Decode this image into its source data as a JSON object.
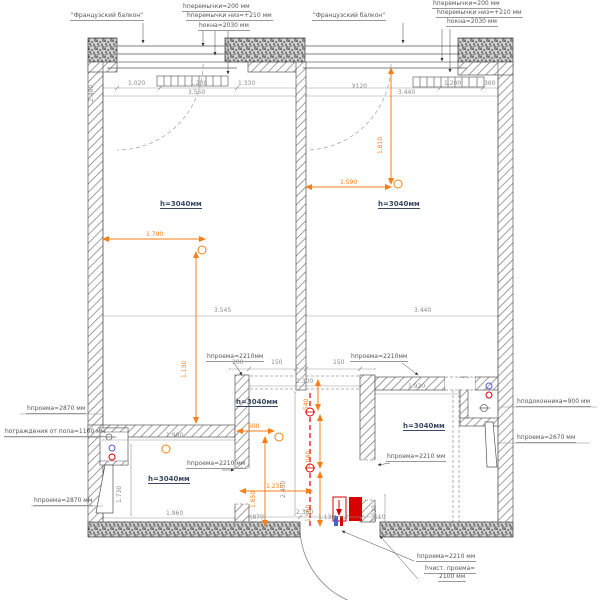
{
  "title": "Обмерный план квартиры (floor plan with heights of openings)",
  "colors": {
    "dim_orange": "#f87f17",
    "accent_red": "#d60000",
    "accent_blue": "#4a5fd0",
    "line_grey": "#8a8a8a",
    "wall_dark": "#444444",
    "room_label": "#3b4a63"
  },
  "rooms": {
    "top_left": {
      "label": "h=3040мм"
    },
    "top_right": {
      "label": "h=3040мм"
    },
    "middle": {
      "label": "h=3040мм"
    },
    "bottom_left": {
      "label": "h=3040мм"
    },
    "bottom_right": {
      "label": "h=3040мм"
    }
  },
  "callouts": [
    {
      "n": "balcony-left-label",
      "t": "\"Французский балкон\"",
      "x": 70,
      "y": 13
    },
    {
      "n": "balcony-right-label",
      "t": "\"Французский балкон\"",
      "x": 312,
      "y": 13
    },
    {
      "n": "lintel-left-label",
      "t": "hперемычки=200 мм",
      "x": 182,
      "y": 4
    },
    {
      "n": "lintel-low-left-label",
      "t": "hперемычки низ=+210 мм",
      "x": 186,
      "y": 13
    },
    {
      "n": "window-left-label",
      "t": "hокна=2030 мм",
      "x": 198,
      "y": 23
    },
    {
      "n": "lintel-right-label",
      "t": "hперемычки=200 мм",
      "x": 432,
      "y": 1
    },
    {
      "n": "lintel-low-right-label",
      "t": "hперемычки низ=+210 мм",
      "x": 436,
      "y": 10
    },
    {
      "n": "window-right-label",
      "t": "hокна=2030 мм",
      "x": 446,
      "y": 19
    },
    {
      "n": "left-opening-label-1",
      "t": "hпроема=2870 мм",
      "x": 26,
      "y": 406
    },
    {
      "n": "left-railing-label",
      "t": "hограждения от пола=1100 мм",
      "x": 4,
      "y": 429
    },
    {
      "n": "left-opening-label-2",
      "t": "hпроема=2870 мм",
      "x": 33,
      "y": 498
    },
    {
      "n": "right-sill-label",
      "t": "hподоконника=900 мм",
      "x": 516,
      "y": 399
    },
    {
      "n": "right-opening-label",
      "t": "hпроема=2670 мм",
      "x": 516,
      "y": 435
    },
    {
      "n": "door-opening-label",
      "t": "hпроема=2210 мм",
      "x": 416,
      "y": 554
    },
    {
      "n": "door-clear-label-1",
      "t": "hчист. проема=",
      "x": 424,
      "y": 566
    },
    {
      "n": "door-clear-label-2",
      "t": "2100 мм",
      "x": 438,
      "y": 574
    },
    {
      "n": "opening-label-bath-left",
      "t": "hпроема=2210мм",
      "x": 206,
      "y": 354
    },
    {
      "n": "opening-label-bath-right",
      "t": "hпроема=2210мм",
      "x": 350,
      "y": 354
    },
    {
      "n": "opening-label-room-left",
      "t": "hпроема=2210 мм",
      "x": 186,
      "y": 461
    },
    {
      "n": "opening-label-room-right",
      "t": "hпроема=2210 мм",
      "x": 386,
      "y": 454
    }
  ],
  "grey_dims": [
    {
      "t": "1.020",
      "x": 128,
      "y": 81
    },
    {
      "t": "1.200",
      "x": 190,
      "y": 81
    },
    {
      "t": "1.330",
      "x": 238,
      "y": 81
    },
    {
      "t": "3.550",
      "x": 188,
      "y": 90
    },
    {
      "t": "У120",
      "x": 352,
      "y": 84
    },
    {
      "t": "3.440",
      "x": 398,
      "y": 90
    },
    {
      "t": "1.200",
      "x": 444,
      "y": 81
    },
    {
      "t": "360",
      "x": 484,
      "y": 81
    },
    {
      "t": "2.480",
      "x": 95,
      "y": 96,
      "v": 1
    },
    {
      "t": "3.545",
      "x": 214,
      "y": 308
    },
    {
      "t": "3.440",
      "x": 414,
      "y": 308
    },
    {
      "t": "200",
      "x": 232,
      "y": 360
    },
    {
      "t": "150",
      "x": 271,
      "y": 360
    },
    {
      "t": "150",
      "x": 333,
      "y": 360
    },
    {
      "t": "2.300",
      "x": 296,
      "y": 379
    },
    {
      "t": "1.920",
      "x": 408,
      "y": 384
    },
    {
      "t": "1.960",
      "x": 166,
      "y": 433
    },
    {
      "t": "1.730",
      "x": 123,
      "y": 497,
      "v": 1
    },
    {
      "t": "2.450",
      "x": 287,
      "y": 492,
      "v": 1
    },
    {
      "t": "1.960",
      "x": 166,
      "y": 511
    },
    {
      "t": "(870)",
      "x": 250,
      "y": 515
    },
    {
      "t": "2.360",
      "x": 296,
      "y": 510
    },
    {
      "t": "1.130",
      "x": 318,
      "y": 515
    },
    {
      "t": "110",
      "x": 374,
      "y": 515
    },
    {
      "t": "1.020",
      "x": 378,
      "y": 516,
      "v": 1
    }
  ],
  "orange_dims": [
    {
      "t": "1.790",
      "x": 146,
      "y": 232
    },
    {
      "t": "1.130",
      "x": 188,
      "y": 372,
      "v": 1
    },
    {
      "t": "1.810",
      "x": 384,
      "y": 148,
      "v": 1
    },
    {
      "t": "1.590",
      "x": 340,
      "y": 180
    },
    {
      "t": "600",
      "x": 248,
      "y": 424
    },
    {
      "t": "1.650",
      "x": 257,
      "y": 502,
      "v": 1
    },
    {
      "t": "540",
      "x": 310,
      "y": 404,
      "v": 1
    },
    {
      "t": "1.040",
      "x": 312,
      "y": 462,
      "v": 1
    },
    {
      "t": "1.560",
      "x": 312,
      "y": 516,
      "v": 1
    },
    {
      "t": "1.235",
      "x": 266,
      "y": 484
    }
  ]
}
